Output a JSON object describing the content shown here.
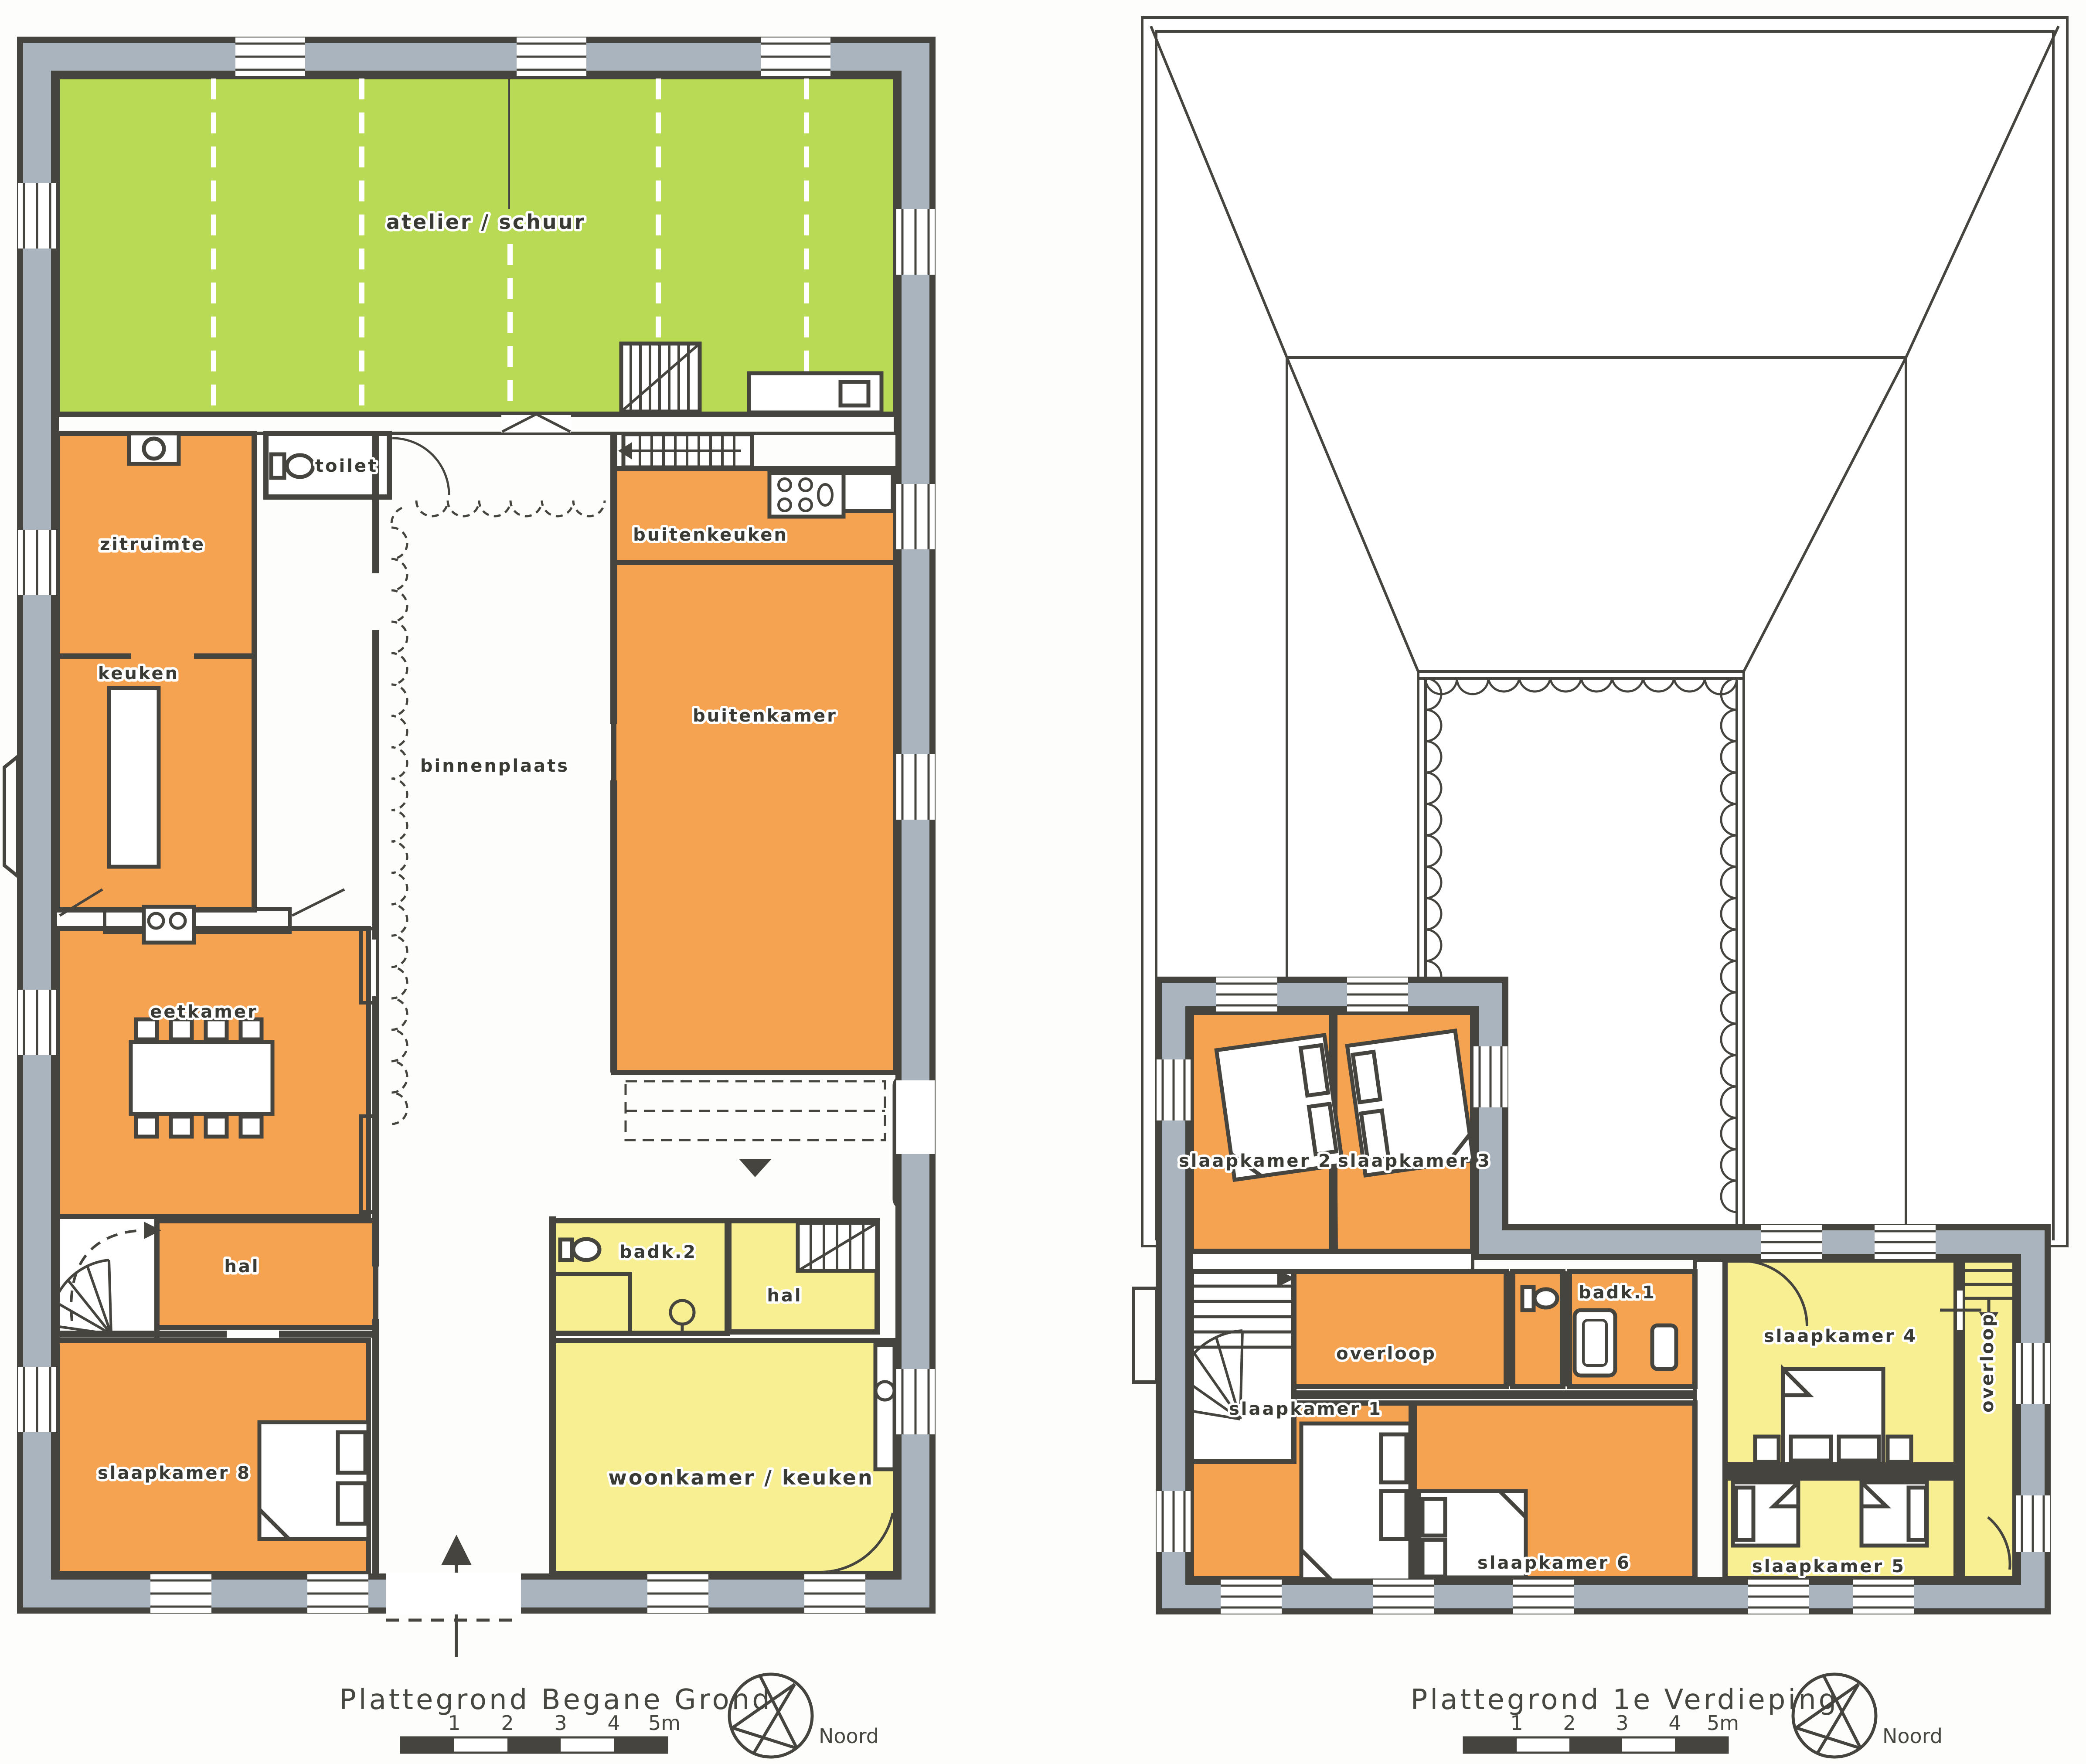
{
  "palette": {
    "orange": "#f5a351",
    "yellow": "#f8ef93",
    "green": "#b9da55",
    "wallgray": "#aab4bf",
    "line": "#45443e"
  },
  "ground_floor": {
    "title": "Plattegrond Begane Grond",
    "rooms": [
      {
        "label": "atelier / schuur",
        "color": "green"
      },
      {
        "label": "toilet",
        "color": "white"
      },
      {
        "label": "zitruimte",
        "color": "orange"
      },
      {
        "label": "keuken",
        "color": "orange"
      },
      {
        "label": "eetkamer",
        "color": "orange"
      },
      {
        "label": "hal",
        "color": "orange"
      },
      {
        "label": "slaapkamer 8",
        "color": "orange"
      },
      {
        "label": "binnenplaats",
        "color": "white"
      },
      {
        "label": "buitenkeuken",
        "color": "orange"
      },
      {
        "label": "buitenkamer",
        "color": "orange"
      },
      {
        "label": "badk.2",
        "color": "yellow"
      },
      {
        "label": "hal",
        "color": "yellow"
      },
      {
        "label": "woonkamer / keuken",
        "color": "yellow"
      }
    ]
  },
  "first_floor": {
    "title": "Plattegrond 1e Verdieping",
    "rooms": [
      {
        "label": "slaapkamer 2",
        "color": "orange"
      },
      {
        "label": "slaapkamer 3",
        "color": "orange"
      },
      {
        "label": "overloop",
        "color": "orange"
      },
      {
        "label": "badk.1",
        "color": "orange"
      },
      {
        "label": "slaapkamer 1",
        "color": "orange"
      },
      {
        "label": "slaapkamer 6",
        "color": "orange"
      },
      {
        "label": "slaapkamer 4",
        "color": "yellow"
      },
      {
        "label": "slaapkamer 5",
        "color": "yellow"
      },
      {
        "label": "overloop",
        "color": "yellow"
      }
    ]
  },
  "legend": {
    "scale_ticks": [
      "1",
      "2",
      "3",
      "4",
      "5m"
    ],
    "north_label": "Noord"
  }
}
